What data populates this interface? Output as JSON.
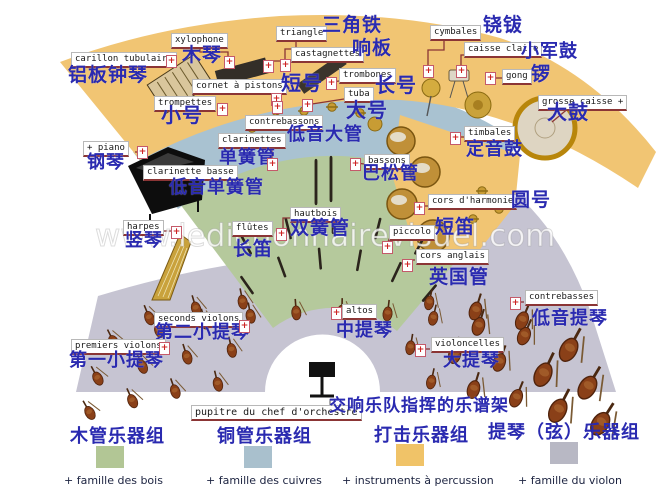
{
  "watermark": "www.ledictionnairevisuel.com",
  "labels": {
    "carillon": {
      "fr": "carillon tubulaire",
      "zh": "铝板钟琴"
    },
    "xylophone": {
      "fr": "xylophone",
      "zh": "木琴"
    },
    "triangle": {
      "fr": "triangle",
      "zh": "三角铁"
    },
    "castagnettes": {
      "fr": "castagnettes",
      "zh": "响板"
    },
    "cymbales": {
      "fr": "cymbales",
      "zh": "铙钹"
    },
    "caisse_claire": {
      "fr": "caisse claire",
      "zh": "小军鼓"
    },
    "gong": {
      "fr": "gong",
      "zh": "锣"
    },
    "grosse_caisse": {
      "fr": "grosse caisse +",
      "zh": "大鼓"
    },
    "cornet": {
      "fr": "cornet à pistons",
      "zh": "短号"
    },
    "trompettes": {
      "fr": "trompettes",
      "zh": "小号"
    },
    "trombones": {
      "fr": "trombones",
      "zh": "长号"
    },
    "tuba": {
      "fr": "tuba",
      "zh": "大号"
    },
    "contrebassons": {
      "fr": "contrebassons",
      "zh": "低音大管"
    },
    "clarinettes": {
      "fr": "clarinettes",
      "zh": "单簧管"
    },
    "piano": {
      "fr": "+ piano",
      "zh": "钢琴"
    },
    "clarinette_basse": {
      "fr": "clarinette basse",
      "zh": "低音单簧管"
    },
    "bassons": {
      "fr": "bassons",
      "zh": "巴松管"
    },
    "timbales": {
      "fr": "timbales",
      "zh": "定音鼓"
    },
    "cors_harmonie": {
      "fr": "cors d'harmonie",
      "zh": "圆号"
    },
    "hautbois": {
      "fr": "hautbois",
      "zh": "双簧管"
    },
    "flutes": {
      "fr": "flûtes",
      "zh": "长笛"
    },
    "piccolo": {
      "fr": "piccolo",
      "zh": "短笛"
    },
    "cors_anglais": {
      "fr": "cors anglais",
      "zh": "英国管"
    },
    "harpes": {
      "fr": "harpes",
      "zh": "竖琴"
    },
    "seconds_violons": {
      "fr": "seconds violons",
      "zh": "第二小提琴"
    },
    "premiers_violons": {
      "fr": "premiers violons",
      "zh": "第一小提琴"
    },
    "altos": {
      "fr": "altos",
      "zh": "中提琴"
    },
    "violoncelles": {
      "fr": "violoncelles",
      "zh": "大提琴"
    },
    "contrebasses": {
      "fr": "contrebasses",
      "zh": "低音提琴"
    },
    "pupitre": {
      "fr": "pupitre du chef d'orchestre",
      "zh": "交响乐队指挥的乐谱架"
    }
  },
  "legend": {
    "items": [
      {
        "zh": "木管乐器组",
        "fr": "+ famille des bois",
        "color": "#b2c695"
      },
      {
        "zh": "铜管乐器组",
        "fr": "+ famille des cuivres",
        "color": "#a9c0cd"
      },
      {
        "zh": "打击乐器组",
        "fr": "+ instruments à percussion",
        "color": "#f0c368"
      },
      {
        "zh": "提琴（弦）乐器组",
        "fr": "+ famille du violon",
        "color": "#b8b8c4"
      }
    ]
  },
  "regions": {
    "percussion": "#f1c573",
    "brass": "#a9c2d1",
    "woodwind": "#b5c99c",
    "strings": "#c6c4d2"
  },
  "accents": {
    "chinese_text": "#2a2ab0",
    "connector_line": "#8b3535",
    "plus_box_border": "#c45a6a",
    "plus_sign": "#cc2222",
    "french_label_text": "#1a1a1a"
  }
}
